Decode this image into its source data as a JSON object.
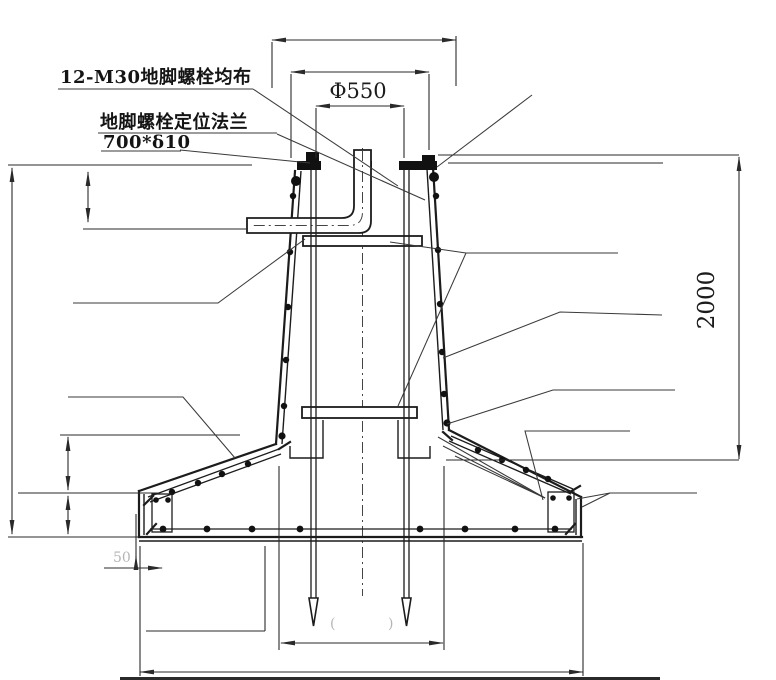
{
  "drawing": {
    "type": "engineering-section-detail",
    "labels": {
      "l1": "12-M30地脚螺栓均布",
      "l2": "地脚螺栓定位法兰",
      "l3": "700*δ10"
    },
    "dims": {
      "d550": "Φ550",
      "d2000": "2000",
      "d50": "50",
      "paren_left": "(",
      "paren_right": ")"
    },
    "colors": {
      "line": "#1c1c1c",
      "faint_dim": "#b5b5b5",
      "background": "#ffffff"
    }
  }
}
